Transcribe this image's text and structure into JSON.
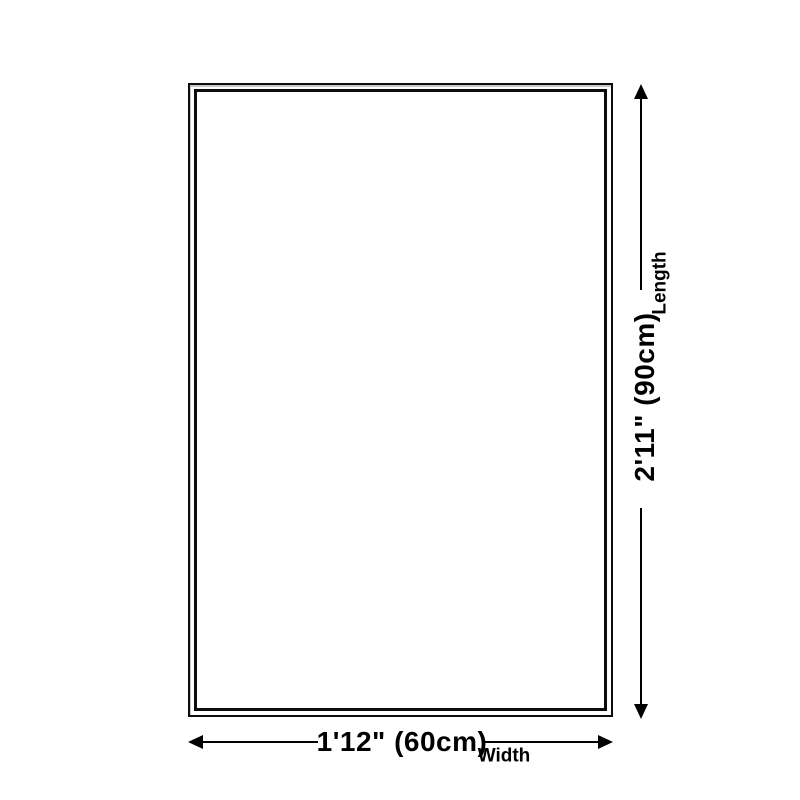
{
  "diagram": {
    "title": "product-dimension-diagram",
    "length": {
      "value_label": "2'11\" (90cm)",
      "axis_label": "Length"
    },
    "width": {
      "value_label": "1'12\" (60cm)",
      "axis_label": "Width"
    },
    "colors": {
      "background": "#ffffff",
      "line": "#000000",
      "outline_border": "#0d0d0d",
      "outline_shadow": "#c9c9c9"
    }
  }
}
